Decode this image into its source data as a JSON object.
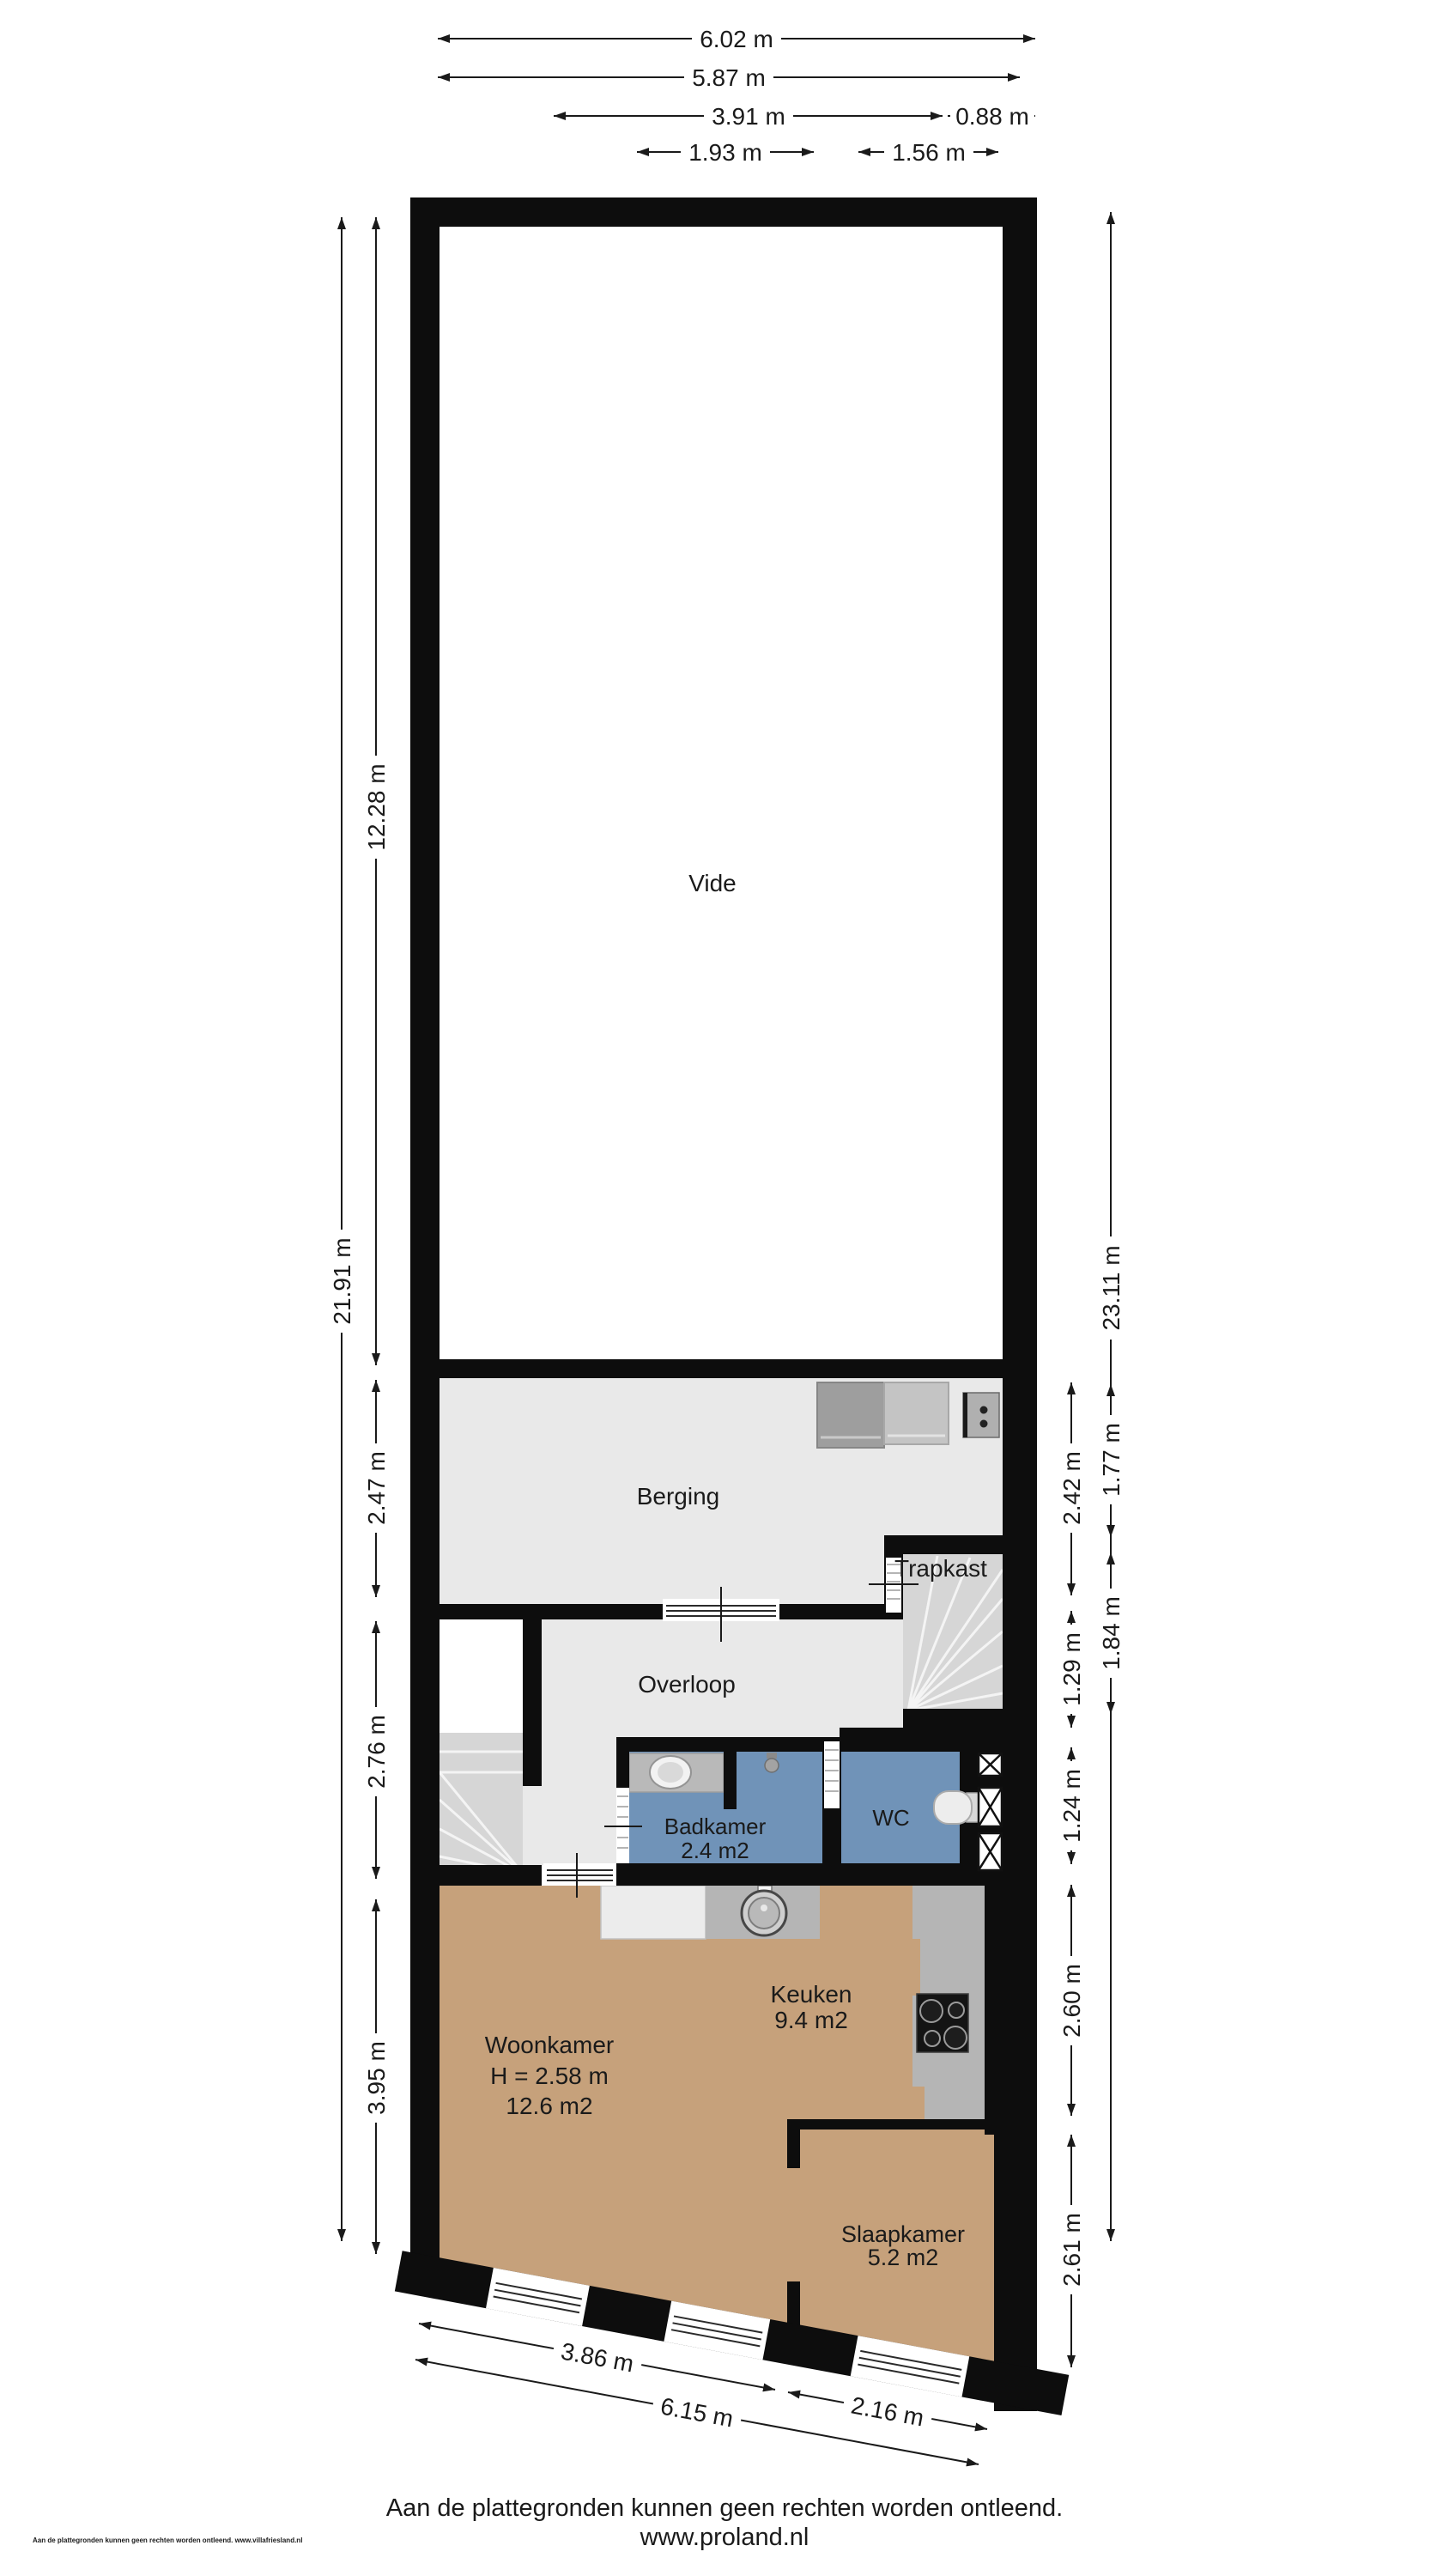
{
  "dimensions": {
    "top": [
      "6.02 m",
      "5.87 m",
      "3.91 m",
      "0.88 m",
      "1.93 m",
      "1.56 m"
    ],
    "left": [
      "21.91 m",
      "12.28 m",
      "2.47 m",
      "2.76 m",
      "3.95 m"
    ],
    "right": [
      "23.11 m",
      "1.77 m",
      "2.42 m",
      "1.84 m",
      "1.29 m",
      "1.24 m",
      "2.60 m",
      "2.61 m"
    ],
    "bottom": [
      "3.86 m",
      "6.15 m",
      "2.16 m"
    ]
  },
  "rooms": {
    "vide": {
      "name": "Vide"
    },
    "berging": {
      "name": "Berging"
    },
    "trapkast": {
      "name": "Trapkast"
    },
    "overloop": {
      "name": "Overloop"
    },
    "badkamer": {
      "name": "Badkamer",
      "area": "2.4 m2"
    },
    "wc": {
      "name": "WC"
    },
    "keuken": {
      "name": "Keuken",
      "area": "9.4 m2"
    },
    "woonkamer": {
      "name": "Woonkamer",
      "ceiling_height": "H = 2.58 m",
      "area": "12.6 m2"
    },
    "slaapkamer": {
      "name": "Slaapkamer",
      "area": "5.2 m2"
    }
  },
  "footer": {
    "disclaimer": "Aan de plattegronden kunnen geen rechten worden ontleend.",
    "website": "www.proland.nl",
    "small_print": "Aan de plattegronden kunnen geen rechten worden ontleend. www.villafriesland.nl"
  },
  "colors": {
    "wall": "#0d0d0d",
    "floor_light": "#e9e9e9",
    "floor_blue": "#7093b8",
    "floor_tan": "#c6a17b",
    "stairs": "#d6d6d6",
    "counter": "#b5b5b5",
    "background": "#ffffff"
  }
}
